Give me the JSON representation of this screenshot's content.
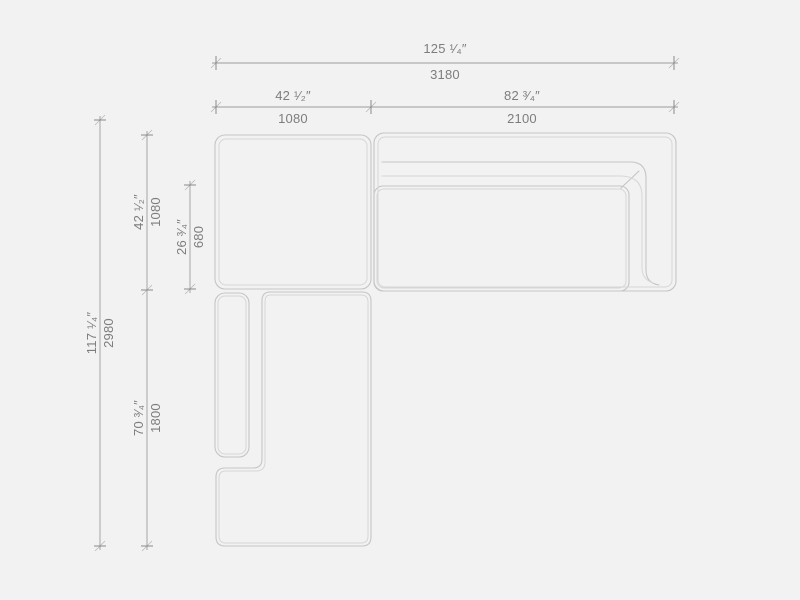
{
  "colors": {
    "background": "#f2f2f2",
    "furniture_line": "#c5c5c5",
    "furniture_line_light": "#d6d6d6",
    "dimension_line": "#9c9c9c",
    "tick_mark": "#8a8a8a",
    "label_text": "#7d7d7d"
  },
  "dimensions": {
    "total_width": {
      "inches": "125 ¹⁄₄″",
      "mm": "3180"
    },
    "seat_module_width": {
      "inches": "42 ¹⁄₂″",
      "mm": "1080"
    },
    "sofa_module_width": {
      "inches": "82 ³⁄₄″",
      "mm": "2100"
    },
    "total_depth": {
      "inches": "117 ¹⁄₄″",
      "mm": "2980"
    },
    "seat_module_depth": {
      "inches": "42 ¹⁄₂″",
      "mm": "1080"
    },
    "seat_cushion_depth": {
      "inches": "26 ³⁄₄″",
      "mm": "680"
    },
    "chaise_module_depth": {
      "inches": "70 ³⁄₄″",
      "mm": "1800"
    }
  }
}
